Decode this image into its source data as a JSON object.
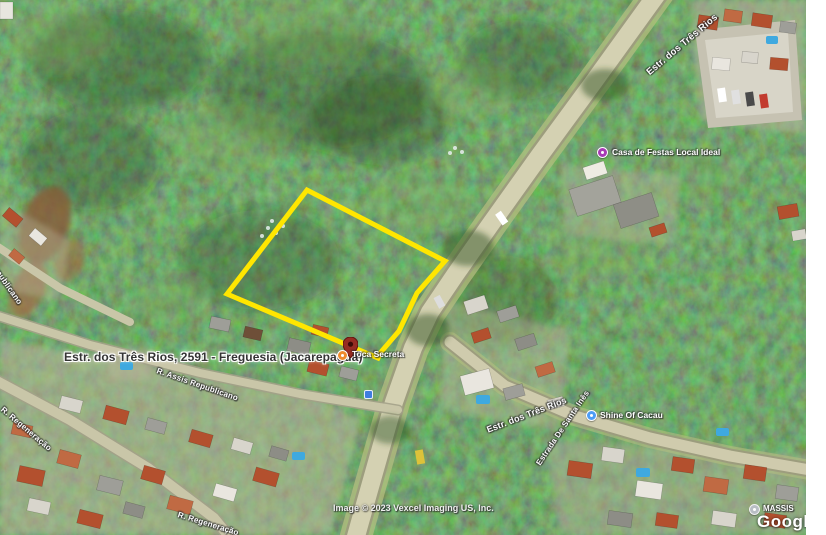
{
  "map": {
    "address_label": "Estr. dos Três Rios, 2591 - Freguesia (Jacarepaguá)",
    "attribution": "Image © 2023 Vexcel Imaging US, Inc.",
    "google_watermark": "Google",
    "partial_watermark_label": "MASSIS",
    "parcel_outline_color": "#ffe600",
    "pin_color": "#962c22",
    "pois": [
      {
        "label": "Toca Secreta",
        "marker_color": "#ef8a2c"
      },
      {
        "label": "Casa de Festas Local Ideal",
        "marker_color": "#a73ab5"
      },
      {
        "label": "Shine Of Cacau",
        "marker_color": "#4d9df6"
      }
    ],
    "streets": [
      {
        "label": "Estr. dos Três Rios"
      },
      {
        "label": "Estr. dos Três Rios"
      },
      {
        "label": "Estrada De Santa Inês"
      },
      {
        "label": "R. Assis Republicano"
      },
      {
        "label": "R. Regeneração"
      },
      {
        "label": "R. Regeneração"
      },
      {
        "label": "R. Assis Republicano"
      }
    ]
  }
}
